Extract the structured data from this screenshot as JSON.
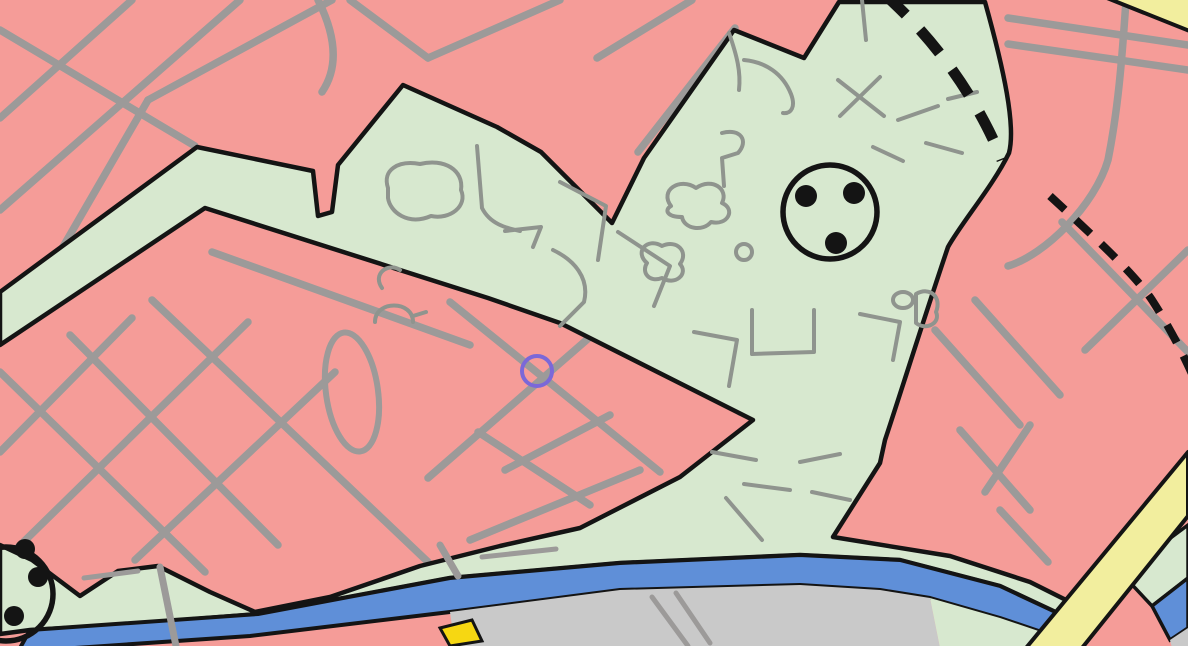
{
  "map": {
    "kind": "land-use-zoning-map-extract",
    "viewport": {
      "width": 1188,
      "height": 646
    },
    "colors": {
      "zone_residential_pink": "#f59c98",
      "zone_green": "#d7e8cf",
      "road_gray": "#9c9a99",
      "detail_gray": "#8f948e",
      "river_blue": "#5f8fd8",
      "built_gray": "#c9c9c9",
      "major_road_yellow": "#f2ee9e",
      "highlight_yellow": "#f6d712",
      "boundary_black": "#141414",
      "marker_purple": "#7b68d8"
    },
    "symbols": [
      {
        "name": "circled-dots-symbol",
        "cx": 830,
        "cy": 212,
        "r": 47,
        "dot_r": 11,
        "dots": [
          [
            806,
            196
          ],
          [
            854,
            193
          ],
          [
            836,
            243
          ]
        ]
      },
      {
        "name": "circled-dots-symbol-partial",
        "cx": 6,
        "cy": 594,
        "r": 47,
        "dot_r": 10,
        "dots": [
          [
            38,
            577
          ],
          [
            14,
            616
          ],
          [
            25,
            549
          ]
        ]
      },
      {
        "name": "selection-ring",
        "cx": 537,
        "cy": 371,
        "r": 15,
        "stroke_width": 4
      }
    ],
    "boundary_dashes": {
      "thick_width": 11,
      "thick_dash": "30 21",
      "thin_width": 8,
      "thin_dash": "20 15"
    }
  }
}
